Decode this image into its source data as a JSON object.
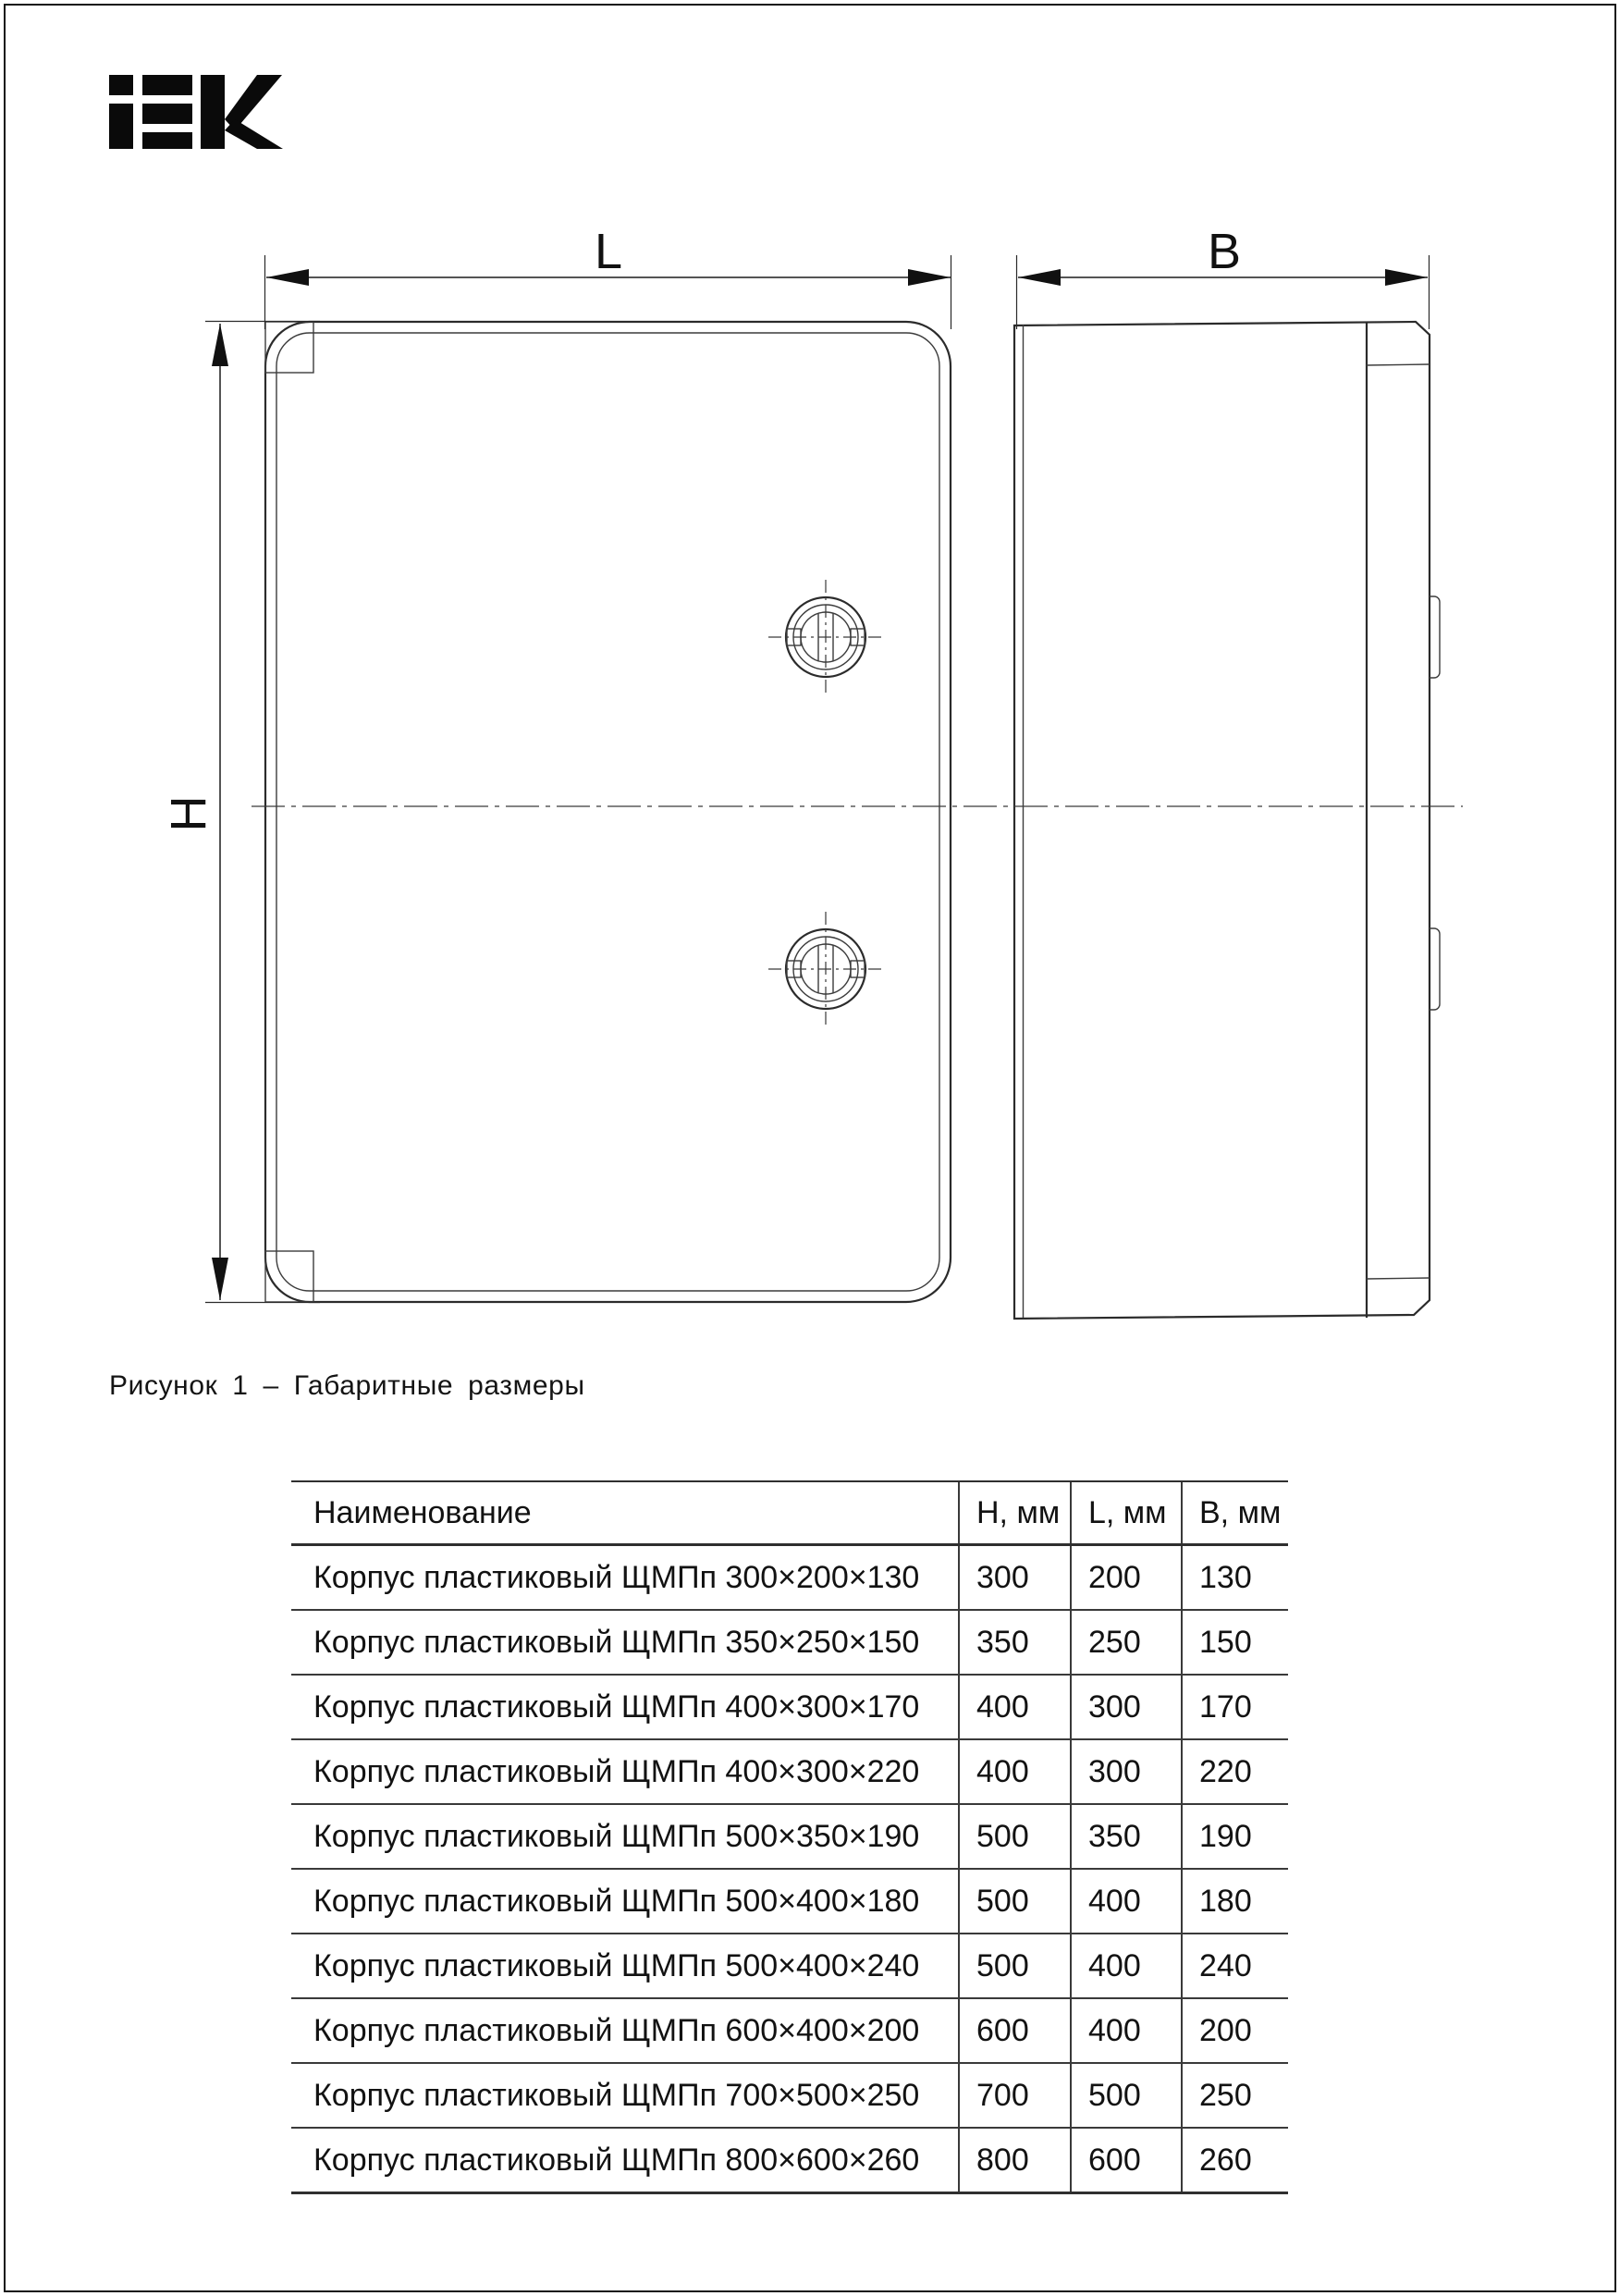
{
  "logo": {
    "name": "IEK"
  },
  "figure": {
    "caption": "Рисунок 1 – Габаритные размеры",
    "dim_length_label": "L",
    "dim_depth_label": "B",
    "dim_height_label": "H"
  },
  "table": {
    "headers": [
      "Наименование",
      "Н, мм",
      "L, мм",
      "В, мм"
    ],
    "rows": [
      {
        "name": "Корпус пластиковый ЩМПп 300×200×130",
        "h": "300",
        "l": "200",
        "b": "130"
      },
      {
        "name": "Корпус пластиковый ЩМПп 350×250×150",
        "h": "350",
        "l": "250",
        "b": "150"
      },
      {
        "name": "Корпус пластиковый ЩМПп 400×300×170",
        "h": "400",
        "l": "300",
        "b": "170"
      },
      {
        "name": "Корпус пластиковый ЩМПп 400×300×220",
        "h": "400",
        "l": "300",
        "b": "220"
      },
      {
        "name": "Корпус пластиковый ЩМПп 500×350×190",
        "h": "500",
        "l": "350",
        "b": "190"
      },
      {
        "name": "Корпус пластиковый ЩМПп 500×400×180",
        "h": "500",
        "l": "400",
        "b": "180"
      },
      {
        "name": "Корпус пластиковый ЩМПп 500×400×240",
        "h": "500",
        "l": "400",
        "b": "240"
      },
      {
        "name": "Корпус пластиковый ЩМПп 600×400×200",
        "h": "600",
        "l": "400",
        "b": "200"
      },
      {
        "name": "Корпус пластиковый ЩМПп 700×500×250",
        "h": "700",
        "l": "500",
        "b": "250"
      },
      {
        "name": "Корпус пластиковый ЩМПп 800×600×260",
        "h": "800",
        "l": "600",
        "b": "260"
      }
    ]
  }
}
